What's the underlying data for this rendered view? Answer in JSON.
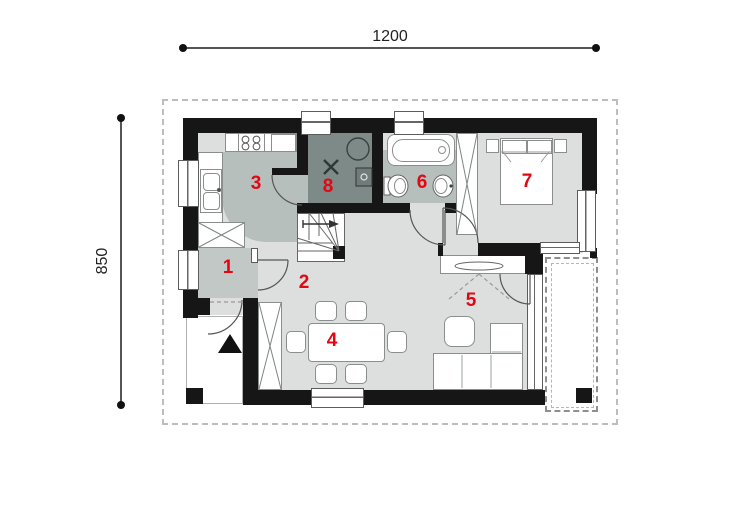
{
  "dimensions": {
    "width_label": "1200",
    "height_label": "850"
  },
  "rooms": [
    {
      "number": "1"
    },
    {
      "number": "2"
    },
    {
      "number": "3"
    },
    {
      "number": "4"
    },
    {
      "number": "5"
    },
    {
      "number": "6"
    },
    {
      "number": "7"
    },
    {
      "number": "8"
    }
  ],
  "colors": {
    "accent_red": "#e30613",
    "wall_black": "#161616",
    "floor_light": "#dcdfde",
    "floor_medium": "#b7bfbd",
    "floor_dark": "#7d8a87"
  }
}
